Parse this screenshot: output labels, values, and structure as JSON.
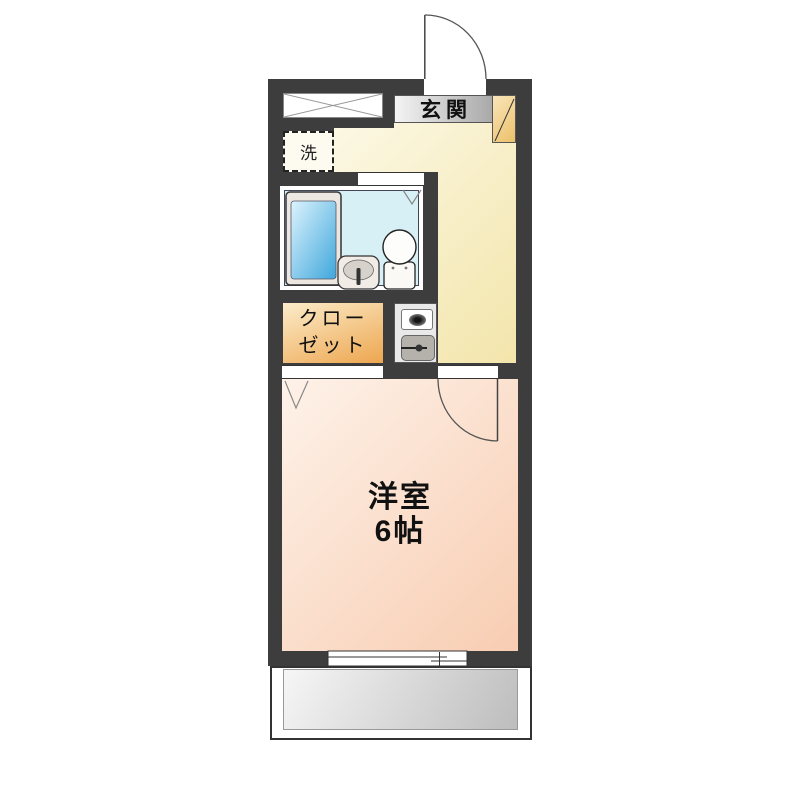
{
  "floorplan": {
    "title": "1K apartment floor plan",
    "rooms": {
      "entrance_label": "玄関",
      "washer_label": "洗",
      "closet_label": [
        "クロー",
        "ゼット"
      ],
      "main_room_label": [
        "洋室",
        "6帖"
      ]
    },
    "fixtures": [
      "entrance-door",
      "shoe-cabinet",
      "storage-crossbox",
      "washing-machine-space",
      "bathtub",
      "vanity-sink",
      "toilet",
      "bathroom-door-mark",
      "closet",
      "kitchen-burner",
      "kitchen-sink",
      "room-door",
      "closet-door-mark",
      "sliding-window",
      "balcony"
    ],
    "colors": {
      "wall": "#3d3d3d",
      "hall_floor": "#f3e5ab",
      "room_floor": "#f8cdb2",
      "closet_fill": "#eda64f",
      "bath_floor": "#d7f0f5",
      "tub_fill": "#47aede",
      "entrance_step": "#a9a9a9",
      "shoe_cabinet_fill": "#ecc06a",
      "balcony_floor": "#bdbdbd"
    }
  }
}
